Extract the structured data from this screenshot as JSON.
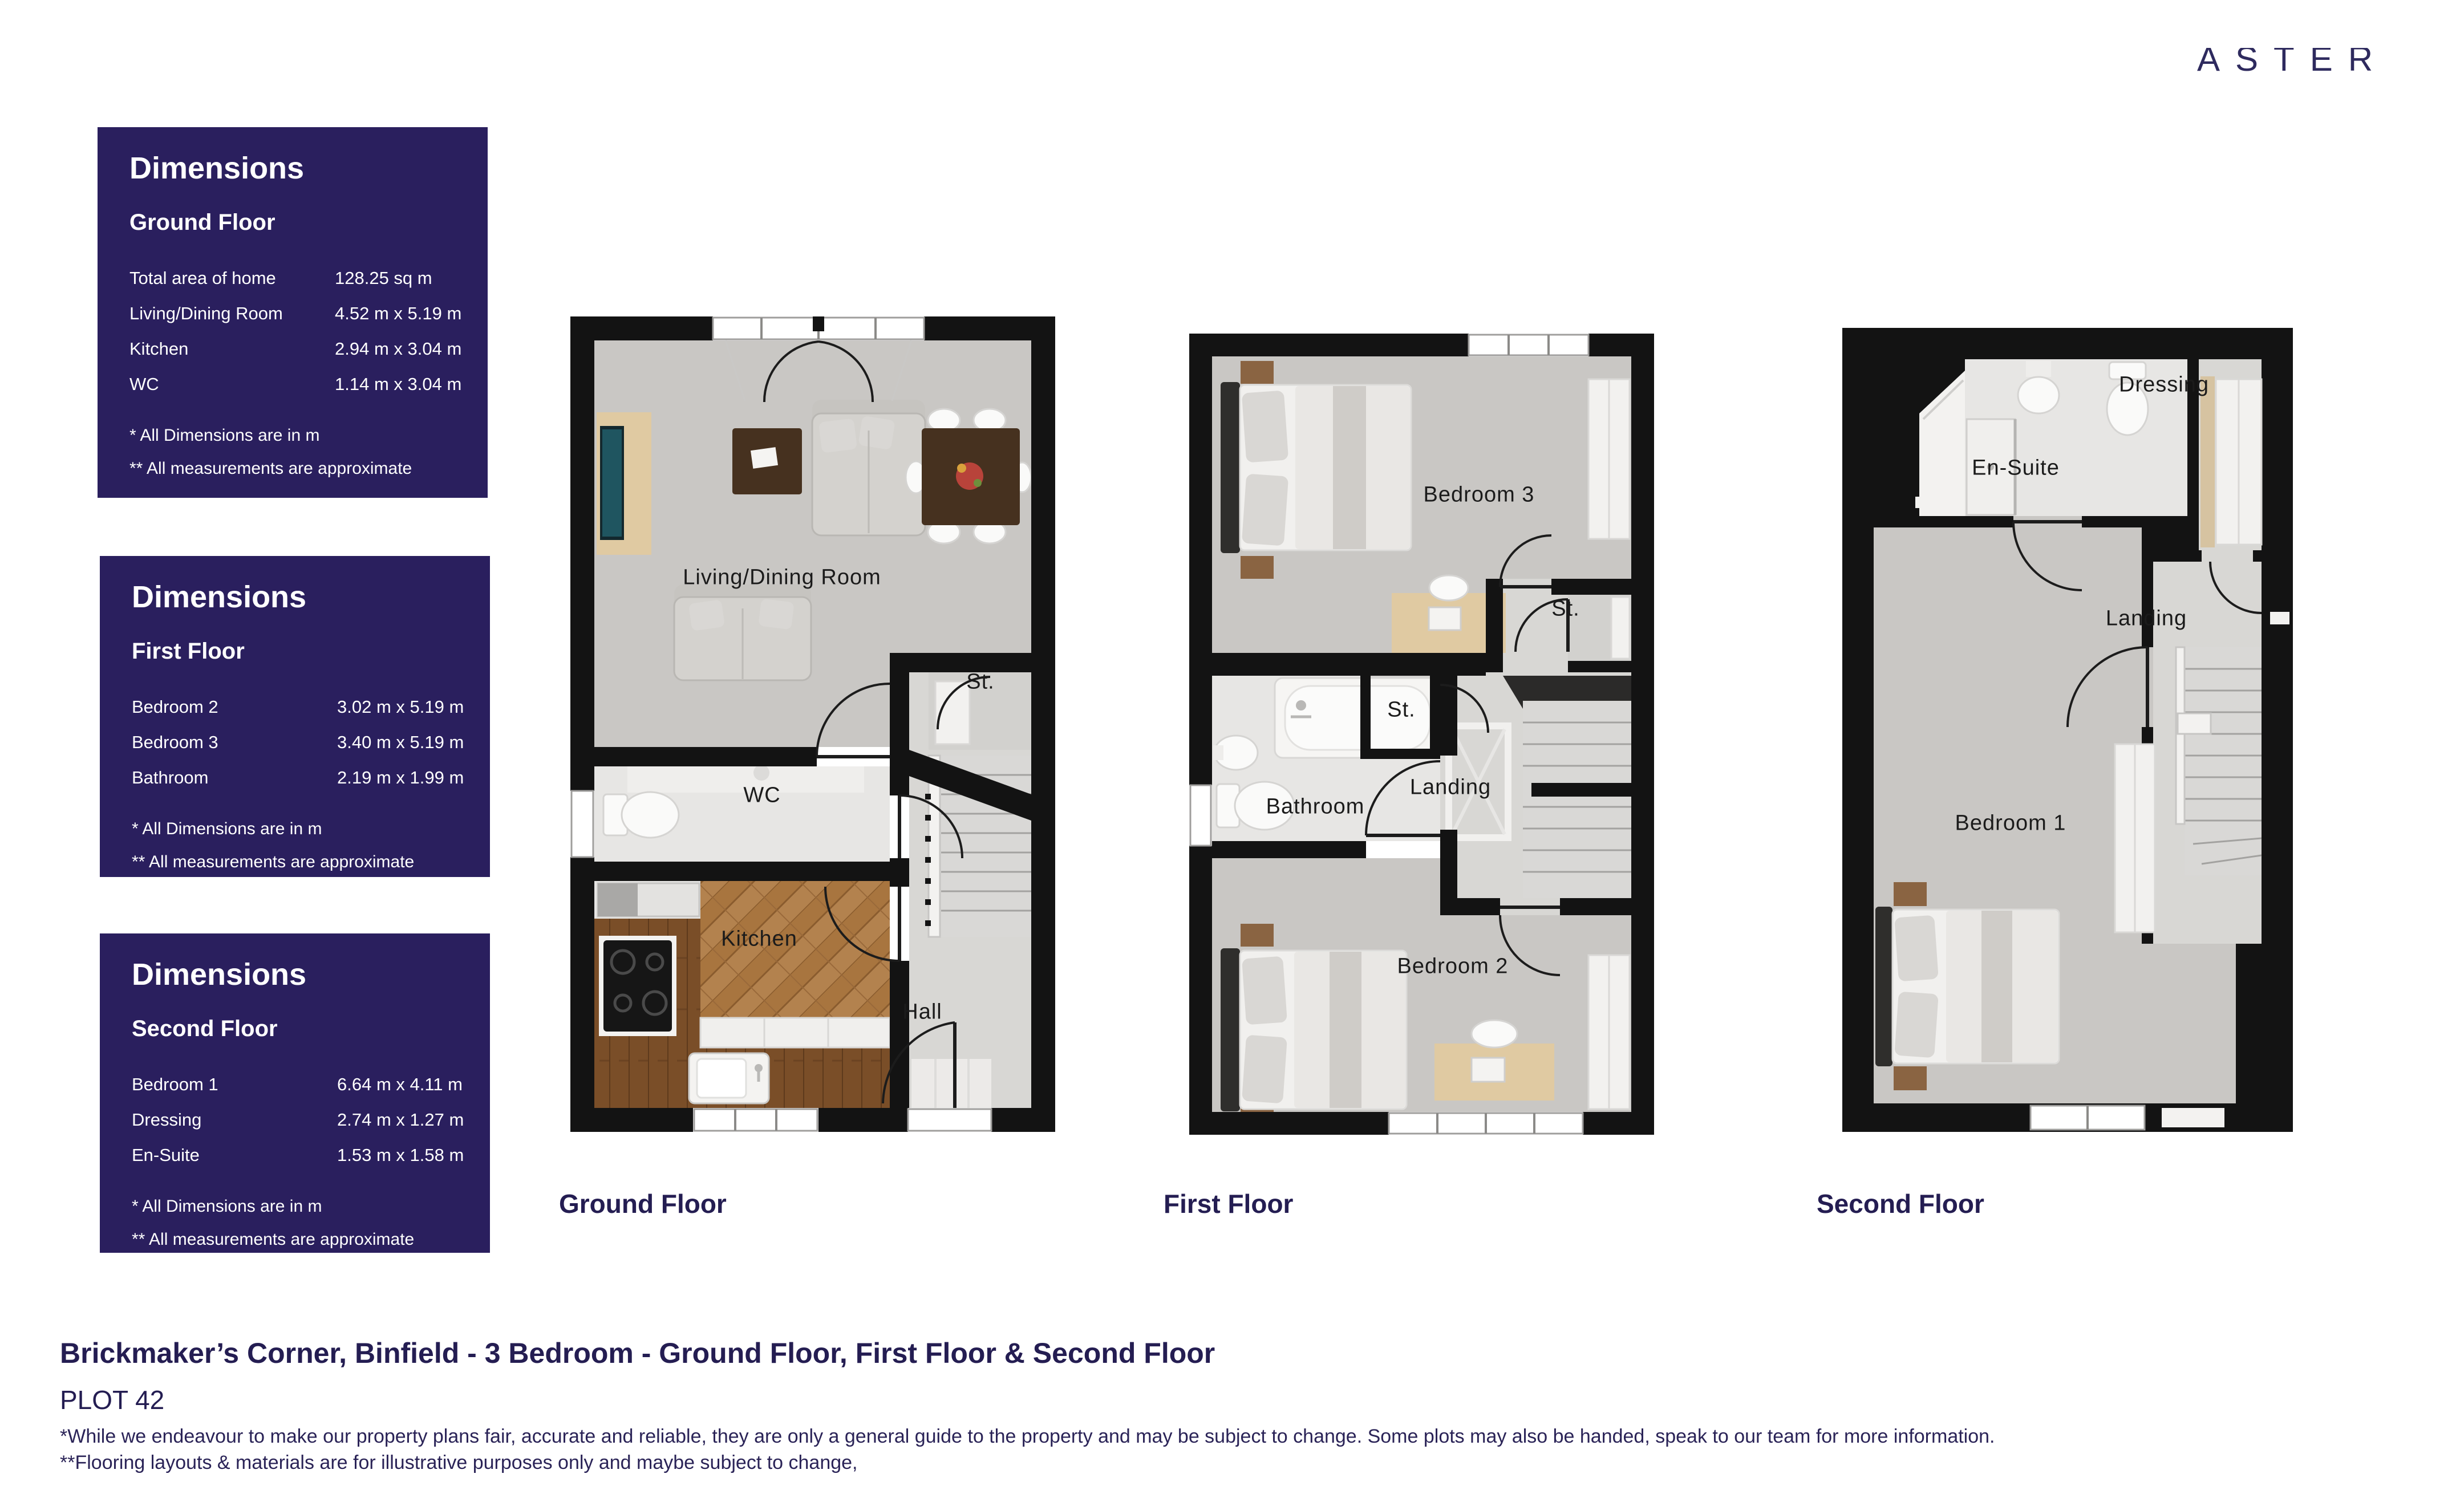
{
  "brand": {
    "logo_text": "ASTER"
  },
  "dimension_panels": [
    {
      "title": "Dimensions",
      "floor": "Ground Floor",
      "rows": [
        {
          "label": "Total area of home",
          "value": "128.25 sq m"
        },
        {
          "label": "Living/Dining Room",
          "value": "4.52 m x 5.19 m"
        },
        {
          "label": "Kitchen",
          "value": "2.94 m x 3.04 m"
        },
        {
          "label": "WC",
          "value": "1.14 m x 3.04 m"
        }
      ],
      "note1": "* All Dimensions are in m",
      "note2": "** All measurements are approximate"
    },
    {
      "title": "Dimensions",
      "floor": "First Floor",
      "rows": [
        {
          "label": "Bedroom 2",
          "value": "3.02 m x 5.19 m"
        },
        {
          "label": "Bedroom 3",
          "value": "3.40 m x 5.19 m"
        },
        {
          "label": "Bathroom",
          "value": "2.19 m x 1.99 m"
        }
      ],
      "note1": "* All Dimensions are in m",
      "note2": "** All measurements are approximate"
    },
    {
      "title": "Dimensions",
      "floor": "Second Floor",
      "rows": [
        {
          "label": "Bedroom 1",
          "value": "6.64 m x 4.11 m"
        },
        {
          "label": "Dressing",
          "value": "2.74 m x 1.27 m"
        },
        {
          "label": "En-Suite",
          "value": "1.53 m x 1.58 m"
        }
      ],
      "note1": "* All Dimensions are in m",
      "note2": "** All measurements are approximate"
    }
  ],
  "floor_plans": [
    {
      "caption": "Ground Floor",
      "labels": {
        "living_dining": "Living/Dining Room",
        "storage": "St.",
        "wc": "WC",
        "kitchen": "Kitchen",
        "hall": "Hall"
      }
    },
    {
      "caption": "First Floor",
      "labels": {
        "bedroom3": "Bedroom 3",
        "storage_top": "St.",
        "storage_mid": "St.",
        "bathroom": "Bathroom",
        "landing": "Landing",
        "bedroom2": "Bedroom 2"
      }
    },
    {
      "caption": "Second Floor",
      "labels": {
        "dressing": "Dressing",
        "ensuite": "En-Suite",
        "landing": "Landing",
        "bedroom1": "Bedroom 1"
      }
    }
  ],
  "footer": {
    "title": "Brickmaker’s Corner, Binfield - 3 Bedroom  - Ground Floor, First Floor & Second Floor",
    "plot": "PLOT 42",
    "disclaimer_line1": "*While we endeavour to make our property plans fair, accurate and reliable, they are only a general guide to the property and may be subject to change. Some plots may also be handed, speak to our team for more information.",
    "disclaimer_line2": "**Flooring layouts & materials are for illustrative purposes only and maybe subject to change,"
  },
  "colors": {
    "panel_navy": "#2a1f5e",
    "text_navy": "#241d52",
    "wall_black": "#131313"
  }
}
